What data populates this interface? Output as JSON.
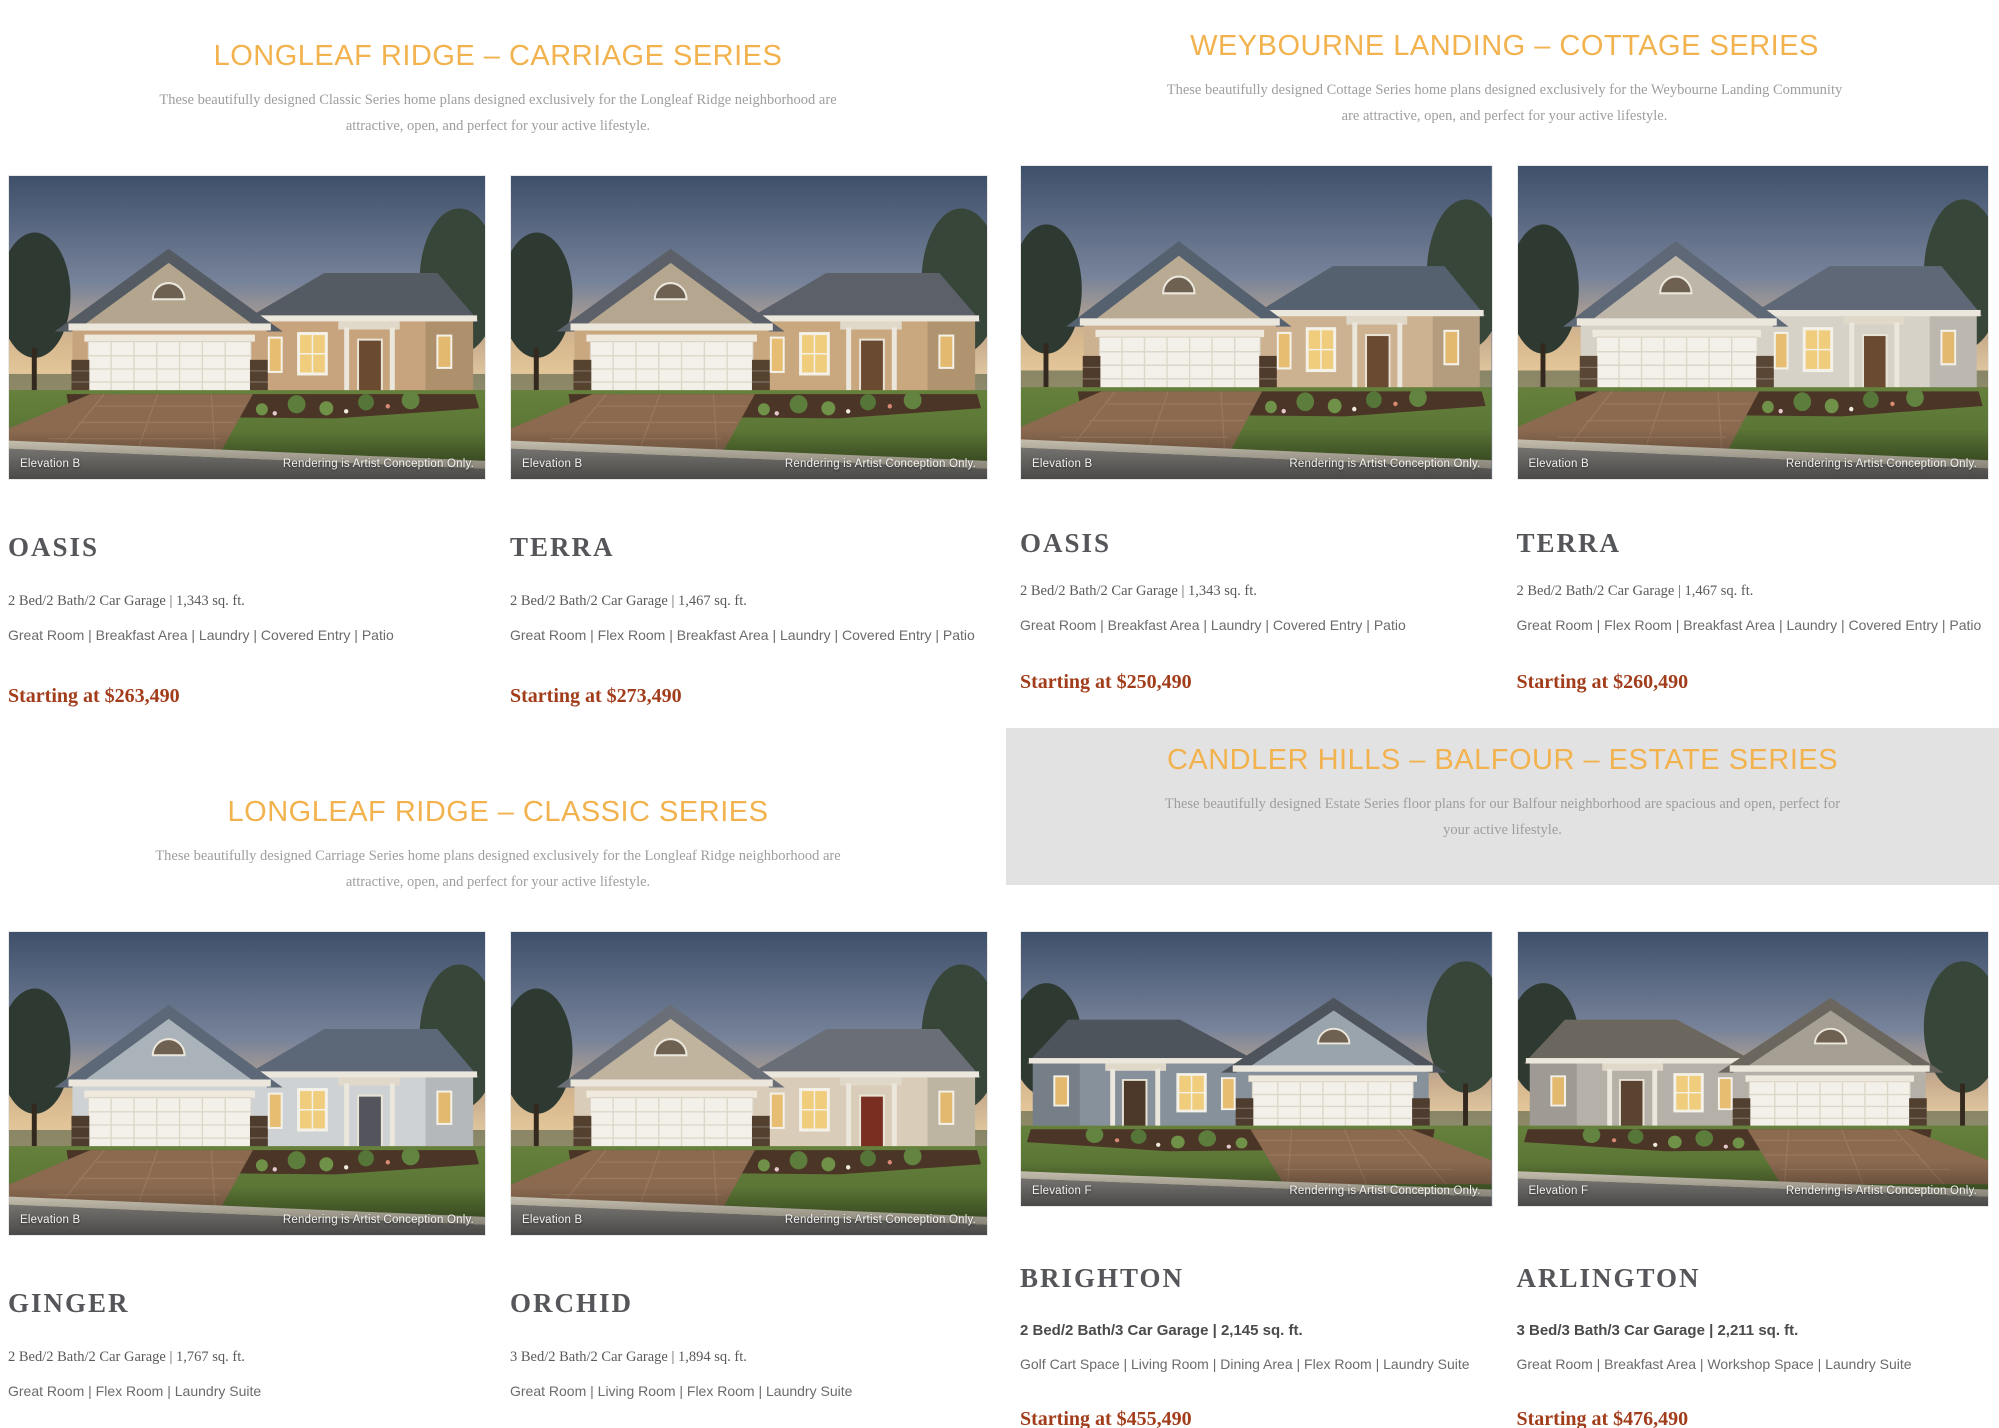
{
  "sections": [
    {
      "id": "longleaf-ridge-carriage",
      "column": "left",
      "title": "LONGLEAF RIDGE – CARRIAGE SERIES",
      "description_lines": [
        "These beautifully designed Classic Series home plans designed exclusively for the Longleaf Ridge neighborhood are",
        "attractive, open, and perfect for your active lifestyle."
      ],
      "plans": [
        {
          "name": "OASIS",
          "specs": "2 Bed/2 Bath/2 Car Garage | 1,343 sq. ft.",
          "features": "Great Room | Breakfast Area | Laundry | Covered Entry | Patio",
          "price": "Starting at $263,490",
          "elevation": "Elevation B",
          "disclaimer": "Rendering is Artist Conception Only.",
          "image": {
            "wall": "#c7a47d",
            "roof": "#555b63",
            "stone": "#53402f",
            "gable": "#b3a58e",
            "door": "#6a4a30",
            "flip": false
          }
        },
        {
          "name": "TERRA",
          "specs": "2 Bed/2 Bath/2 Car Garage | 1,467 sq. ft.",
          "features": "Great Room | Flex Room | Breakfast Area | Laundry | Covered Entry | Patio",
          "price": "Starting at $273,490",
          "elevation": "Elevation B",
          "disclaimer": "Rendering is Artist Conception Only.",
          "image": {
            "wall": "#c9a87f",
            "roof": "#5b6069",
            "stone": "#55422f",
            "gable": "#b5a78f",
            "door": "#6a4a30",
            "flip": false
          }
        }
      ]
    },
    {
      "id": "longleaf-ridge-classic",
      "column": "left",
      "title": "LONGLEAF RIDGE – CLASSIC SERIES",
      "description_lines": [
        "These beautifully designed Carriage Series home plans designed exclusively for the Longleaf Ridge neighborhood are",
        "attractive, open, and perfect for your active lifestyle."
      ],
      "plans": [
        {
          "name": "GINGER",
          "specs": "2 Bed/2 Bath/2 Car Garage | 1,767 sq. ft.",
          "features": "Great Room | Flex Room | Laundry Suite",
          "price": "Starting at $340,990",
          "elevation": "Elevation B",
          "disclaimer": "Rendering is Artist Conception Only.",
          "image": {
            "wall": "#cfd2d4",
            "roof": "#5c6877",
            "stone": "#4e3d2e",
            "gable": "#aab3ba",
            "door": "#54545c",
            "flip": false
          }
        },
        {
          "name": "ORCHID",
          "specs": "3 Bed/2 Bath/2 Car Garage | 1,894 sq. ft.",
          "features": "Great Room | Living Room | Flex Room | Laundry Suite",
          "price": "Starting at $343,990",
          "elevation": "Elevation B",
          "disclaimer": "Rendering is Artist Conception Only.",
          "image": {
            "wall": "#d9cdb9",
            "roof": "#6a6f77",
            "stone": "#53402f",
            "gable": "#c0b49e",
            "door": "#7a2e22",
            "flip": false
          }
        }
      ]
    },
    {
      "id": "weybourne-landing-cottage",
      "column": "right",
      "title": "WEYBOURNE LANDING – COTTAGE SERIES",
      "description_lines": [
        "These beautifully designed Cottage Series home plans designed exclusively for the Weybourne Landing Community",
        "are attractive, open, and perfect for your active lifestyle."
      ],
      "plans": [
        {
          "name": "OASIS",
          "specs": "2 Bed/2 Bath/2 Car Garage | 1,343 sq. ft.",
          "features": "Great Room | Breakfast Area | Laundry | Covered Entry | Patio",
          "price": "Starting at $250,490",
          "elevation": "Elevation B",
          "disclaimer": "Rendering is Artist Conception Only.",
          "image": {
            "wall": "#cdb291",
            "roof": "#566170",
            "stone": "#4f3b2b",
            "gable": "#b9ab93",
            "door": "#6a4a30",
            "flip": false
          }
        },
        {
          "name": "TERRA",
          "specs": "2 Bed/2 Bath/2 Car Garage | 1,467 sq. ft.",
          "features": "Great Room | Flex Room | Breakfast Area | Laundry | Covered Entry | Patio",
          "price": "Starting at $260,490",
          "elevation": "Elevation B",
          "disclaimer": "Rendering is Artist Conception Only.",
          "image": {
            "wall": "#d7d2c8",
            "roof": "#5e6876",
            "stone": "#5a4634",
            "gable": "#bdb6a9",
            "door": "#6a4a30",
            "flip": false
          }
        }
      ]
    },
    {
      "id": "candler-hills-balfour-estate",
      "column": "right",
      "title": "CANDLER HILLS – BALFOUR – ESTATE SERIES",
      "description_lines": [
        "These beautifully designed Estate Series floor plans for our Balfour neighborhood are spacious and open, perfect for",
        "your active lifestyle."
      ],
      "plans": [
        {
          "name": "BRIGHTON",
          "specs": "2 Bed/2 Bath/3 Car Garage | 2,145 sq. ft.",
          "features": "Golf Cart Space | Living Room | Dining Area | Flex Room | Laundry Suite",
          "price": "Starting at $455,490",
          "elevation": "Elevation F",
          "disclaimer": "Rendering is Artist Conception Only.",
          "image": {
            "wall": "#87919b",
            "roof": "#4e545c",
            "stone": "#4e3c2e",
            "gable": "#9aa4ad",
            "door": "#4b3828",
            "flip": true
          }
        },
        {
          "name": "ARLINGTON",
          "specs": "3 Bed/3 Bath/3 Car Garage | 2,211 sq. ft.",
          "features": "Great Room | Breakfast Area | Workshop Space | Laundry Suite",
          "price": "Starting at $476,490",
          "elevation": "Elevation F",
          "disclaimer": "Rendering is Artist Conception Only.",
          "image": {
            "wall": "#b5b1a9",
            "roof": "#6b675f",
            "stone": "#51402f",
            "gable": "#a59f94",
            "door": "#5a4330",
            "flip": true
          }
        }
      ]
    }
  ],
  "colors": {
    "section_title": "#f2b24e",
    "description_text": "#9e9e9e",
    "plan_name": "#55565a",
    "price_text": "#a23d1b",
    "estate_band_background": "#e2e2e2"
  }
}
